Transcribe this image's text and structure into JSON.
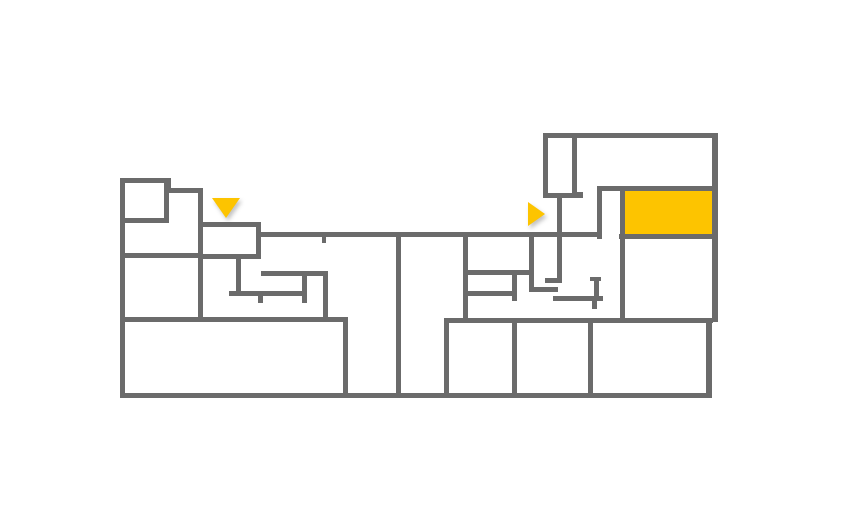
{
  "canvas": {
    "width": 857,
    "height": 510
  },
  "colors": {
    "background": "#ffffff",
    "wall": "#6b6b6b",
    "highlight": "#fdc400"
  },
  "floorplan": {
    "description_name": "building-floor-plan",
    "walls": [
      [
        120,
        178,
        5,
        220
      ],
      [
        120,
        393,
        592,
        5
      ],
      [
        120,
        178,
        51,
        5
      ],
      [
        166,
        178,
        5,
        15
      ],
      [
        166,
        188,
        37,
        5
      ],
      [
        198,
        188,
        5,
        134
      ],
      [
        120,
        218,
        48,
        5
      ],
      [
        164,
        178,
        5,
        45
      ],
      [
        120,
        253,
        83,
        5
      ],
      [
        198,
        222,
        63,
        5
      ],
      [
        256,
        222,
        5,
        37
      ],
      [
        203,
        254,
        58,
        5
      ],
      [
        261,
        232,
        340,
        5
      ],
      [
        236,
        258,
        5,
        38
      ],
      [
        229,
        291,
        78,
        5
      ],
      [
        261,
        271,
        67,
        5
      ],
      [
        302,
        276,
        5,
        16
      ],
      [
        258,
        296,
        5,
        7
      ],
      [
        302,
        296,
        5,
        7
      ],
      [
        323,
        271,
        5,
        51
      ],
      [
        120,
        317,
        228,
        5
      ],
      [
        343,
        317,
        5,
        81
      ],
      [
        396,
        232,
        5,
        166
      ],
      [
        322,
        237,
        4,
        6
      ],
      [
        463,
        232,
        5,
        91
      ],
      [
        444,
        318,
        269,
        5
      ],
      [
        444,
        318,
        5,
        80
      ],
      [
        512,
        270,
        5,
        31
      ],
      [
        468,
        270,
        66,
        5
      ],
      [
        468,
        291,
        45,
        5
      ],
      [
        529,
        232,
        5,
        60
      ],
      [
        534,
        287,
        24,
        5
      ],
      [
        557,
        198,
        5,
        85
      ],
      [
        545,
        278,
        17,
        5
      ],
      [
        543,
        193,
        40,
        5
      ],
      [
        543,
        133,
        5,
        65
      ],
      [
        543,
        133,
        175,
        5
      ],
      [
        712,
        133,
        6,
        189
      ],
      [
        706,
        322,
        6,
        76
      ],
      [
        572,
        133,
        5,
        63
      ],
      [
        574,
        192,
        9,
        5
      ],
      [
        597,
        186,
        121,
        5
      ],
      [
        597,
        186,
        5,
        53
      ],
      [
        620,
        188,
        5,
        134
      ],
      [
        619,
        234,
        98,
        5
      ],
      [
        590,
        277,
        11,
        4
      ],
      [
        594,
        277,
        5,
        24
      ],
      [
        553,
        296,
        50,
        5
      ],
      [
        592,
        301,
        5,
        8
      ],
      [
        588,
        318,
        5,
        80
      ],
      [
        512,
        318,
        5,
        80
      ]
    ],
    "highlight_room": {
      "x": 622,
      "y": 189,
      "w": 93,
      "h": 48
    },
    "markers": [
      {
        "type": "down",
        "name": "entrance-marker-down-icon",
        "x": 212,
        "y": 198
      },
      {
        "type": "right",
        "name": "entrance-marker-right-icon",
        "x": 528,
        "y": 202
      }
    ]
  }
}
